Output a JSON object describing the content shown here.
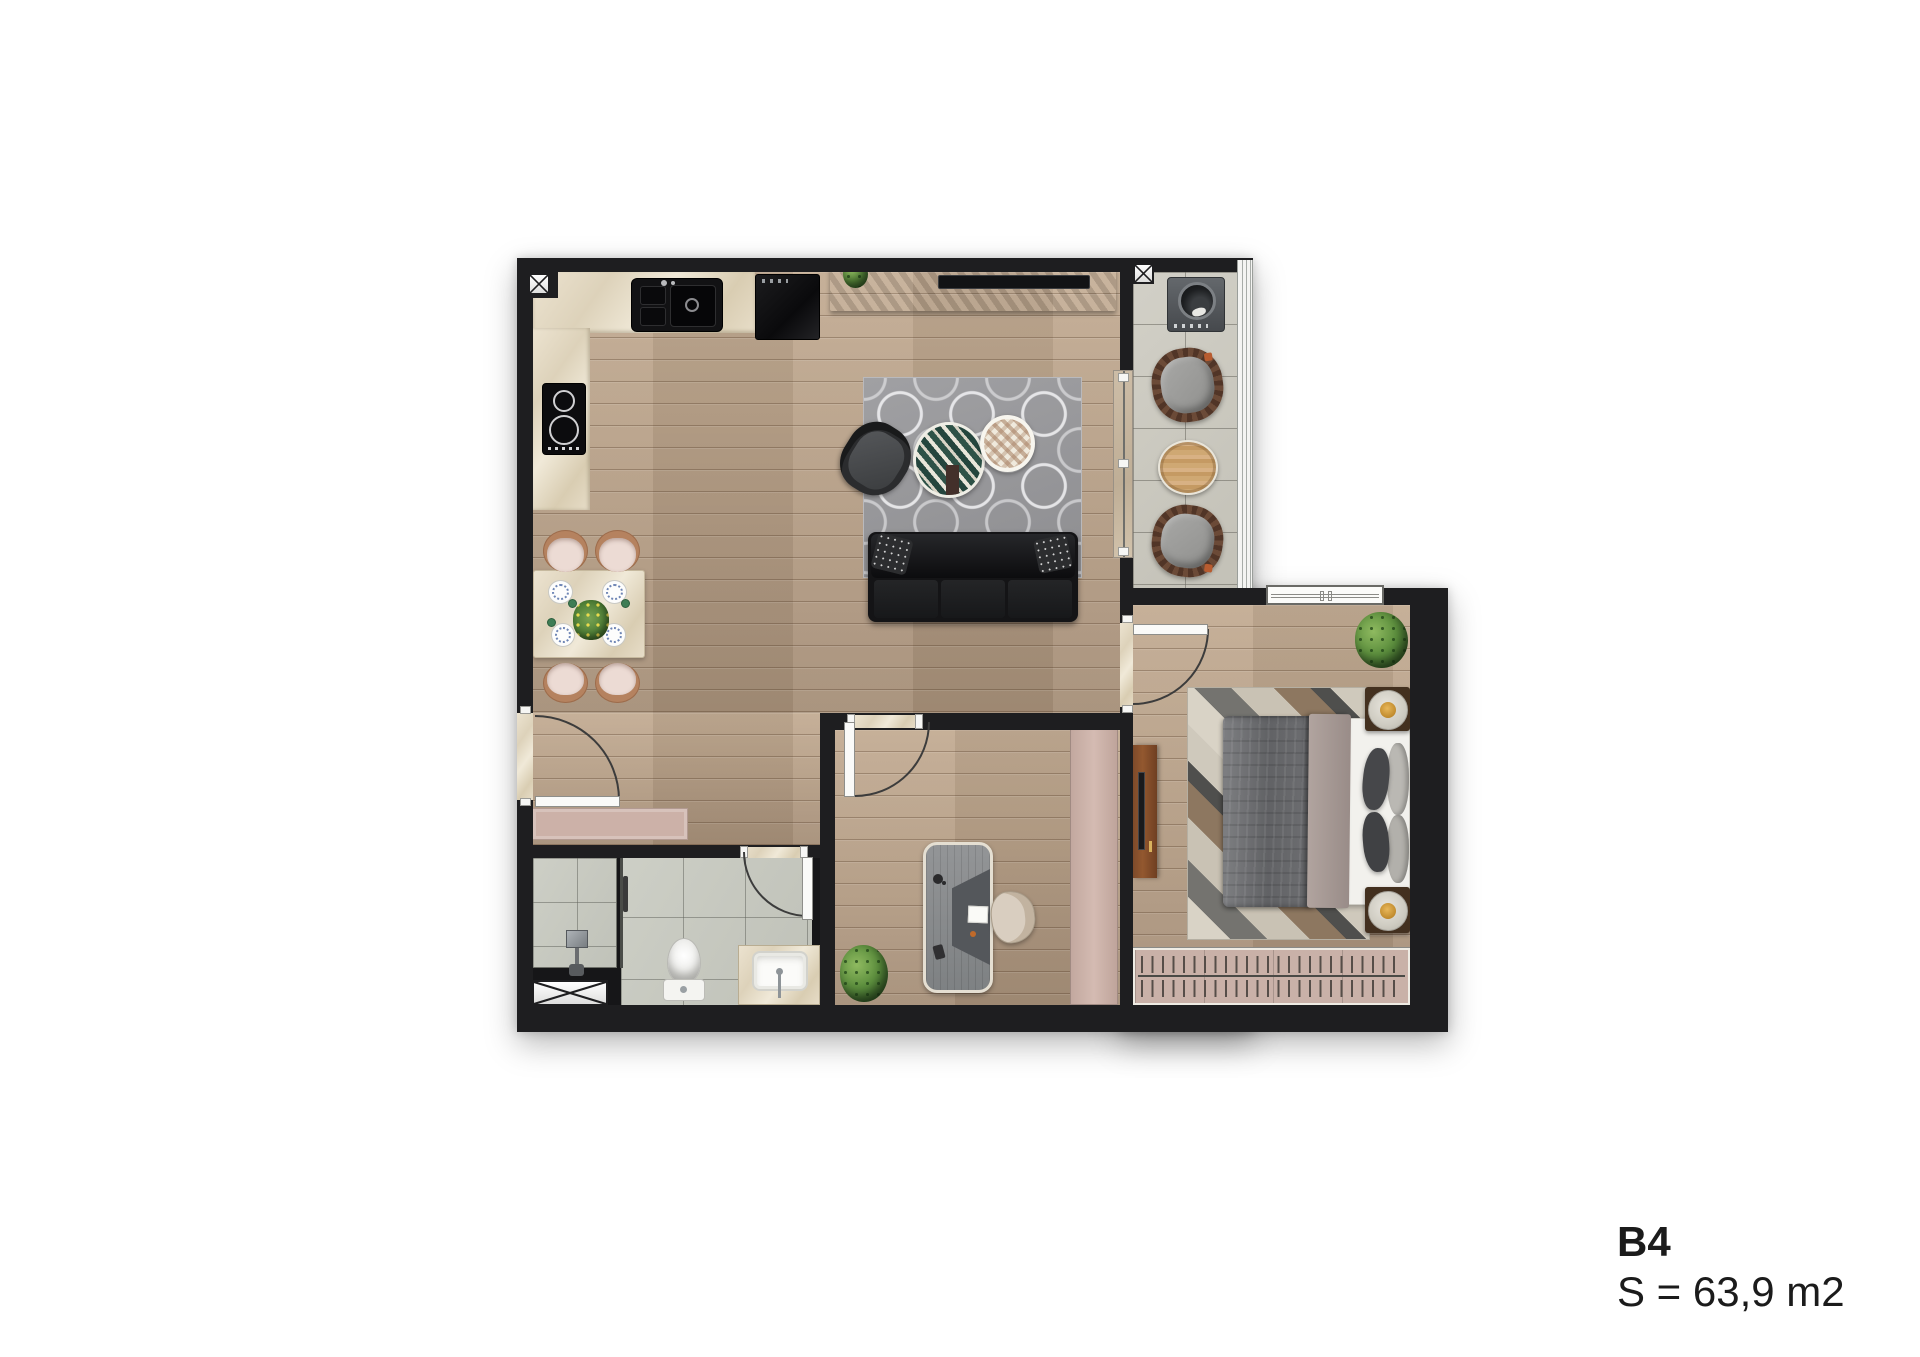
{
  "label": {
    "unit": "B4",
    "area": "S = 63,9 m2"
  },
  "plan": {
    "type": "apartment-floor-plan",
    "colors": {
      "wall": "#1e1e20",
      "wood_floor": "#b39c84",
      "marble_counter": "#e6dcc6",
      "balcony_tile": "#cbc9c0",
      "bath_tile": "#c7c9c1",
      "living_rug": "#97979a",
      "accent_rose": "#ccb1a8",
      "sofa_leather": "#141416",
      "plant_green": "#5d8f3e",
      "bed_blanket": "#6f7072"
    },
    "symbols": [
      "shaft-x-kitchen",
      "shaft-x-balcony",
      "shaft-x-bathroom"
    ],
    "features": [
      "kitchen",
      "dining",
      "living",
      "balcony",
      "bedroom",
      "office",
      "bathroom",
      "entry"
    ]
  }
}
